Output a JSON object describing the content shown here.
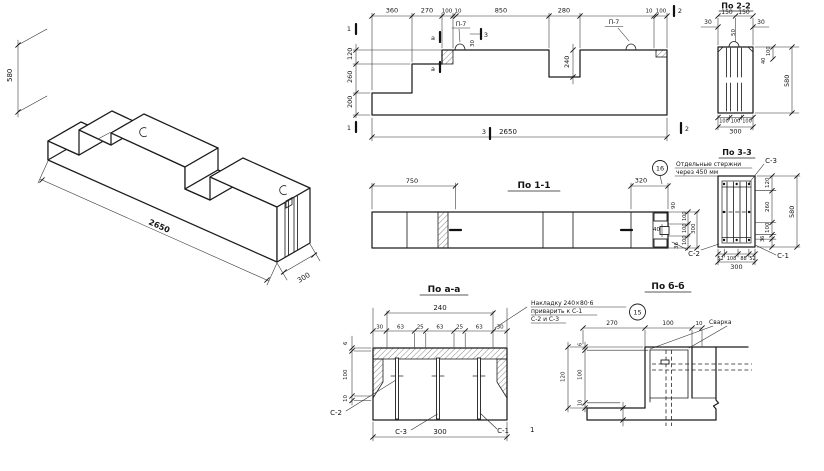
{
  "views": {
    "isometric": {
      "dim_height": "580",
      "dim_length": "2650",
      "dim_width": "300"
    },
    "elevation": {
      "top_dims": {
        "d1": "360",
        "d2": "270",
        "d3": "100",
        "d4": "10",
        "d5": "850",
        "d6": "280",
        "d7": "10",
        "d8": "100"
      },
      "left_dims": {
        "d1": "120",
        "d2": "260",
        "d3": "200"
      },
      "notch_depth": "240",
      "total_length": "2650",
      "loop_label_left": "П-7",
      "loop_label_right": "П-7",
      "loop_height": "30",
      "mark_1_top": "1",
      "mark_1_bottom": "1",
      "mark_2_top": "2",
      "mark_2_bottom": "2",
      "mark_3_top": "3",
      "mark_3_bottom": "3",
      "mark_a_top": "а",
      "mark_a_bottom": "а"
    },
    "section_2_2": {
      "title": "По 2-2",
      "top_dims": {
        "d1": "150",
        "d2": "150"
      },
      "side_left": "30",
      "side_right": "30",
      "loop_depth": "50",
      "right_dims": {
        "d1": "100",
        "d2": "40"
      },
      "dim_height": "580",
      "bottom_dims": {
        "d1": "100",
        "d2": "100",
        "d3": "100"
      },
      "bottom_total": "300"
    },
    "section_1_1": {
      "title": "По 1-1",
      "dim_750": "750",
      "dim_320": "320",
      "end_dims": {
        "d90": "90",
        "d40": "40",
        "d100a": "100",
        "d100b": "100",
        "d100c": "100",
        "d300": "300",
        "d36": "36"
      }
    },
    "section_3_3": {
      "title": "По 3-3",
      "callout_number": "16",
      "note_line1": "Отдельные стержни",
      "note_line2": "через 450 мм",
      "label_c1": "С-1",
      "label_c2": "С-2",
      "label_c3": "С-3",
      "right_dims": {
        "d1": "120",
        "d2": "260",
        "d3": "100"
      },
      "dim_36": "36",
      "dim_height": "580",
      "bottom_dims": {
        "d1": "52",
        "d2": "108",
        "d3": "88",
        "d4": "52"
      },
      "bottom_total": "300"
    },
    "section_a_a": {
      "title": "По а-а",
      "top_total": "240",
      "top_dims": {
        "d1": "30",
        "d2": "63",
        "d3": "25",
        "d4": "63",
        "d5": "25",
        "d6": "63",
        "d7": "30"
      },
      "left_dims": {
        "d1": "6",
        "d2": "100",
        "d3": "10"
      },
      "bottom_total": "300",
      "label_c1": "С-1",
      "label_c2": "С-2",
      "label_c3": "С-3"
    },
    "section_b_b": {
      "title": "По б-б",
      "callout_number": "15",
      "note_line1": "Накладку 240×80·6",
      "note_line2": "приварить к С-1",
      "note_line3": "С-2 и С-3",
      "dim_270": "270",
      "dim_100": "100",
      "dim_10": "10",
      "weld_label": "Сварка",
      "left_total": "120",
      "left_dims": {
        "d1": "6",
        "d2": "100",
        "d3": "10"
      },
      "corner_mark": "1"
    }
  }
}
